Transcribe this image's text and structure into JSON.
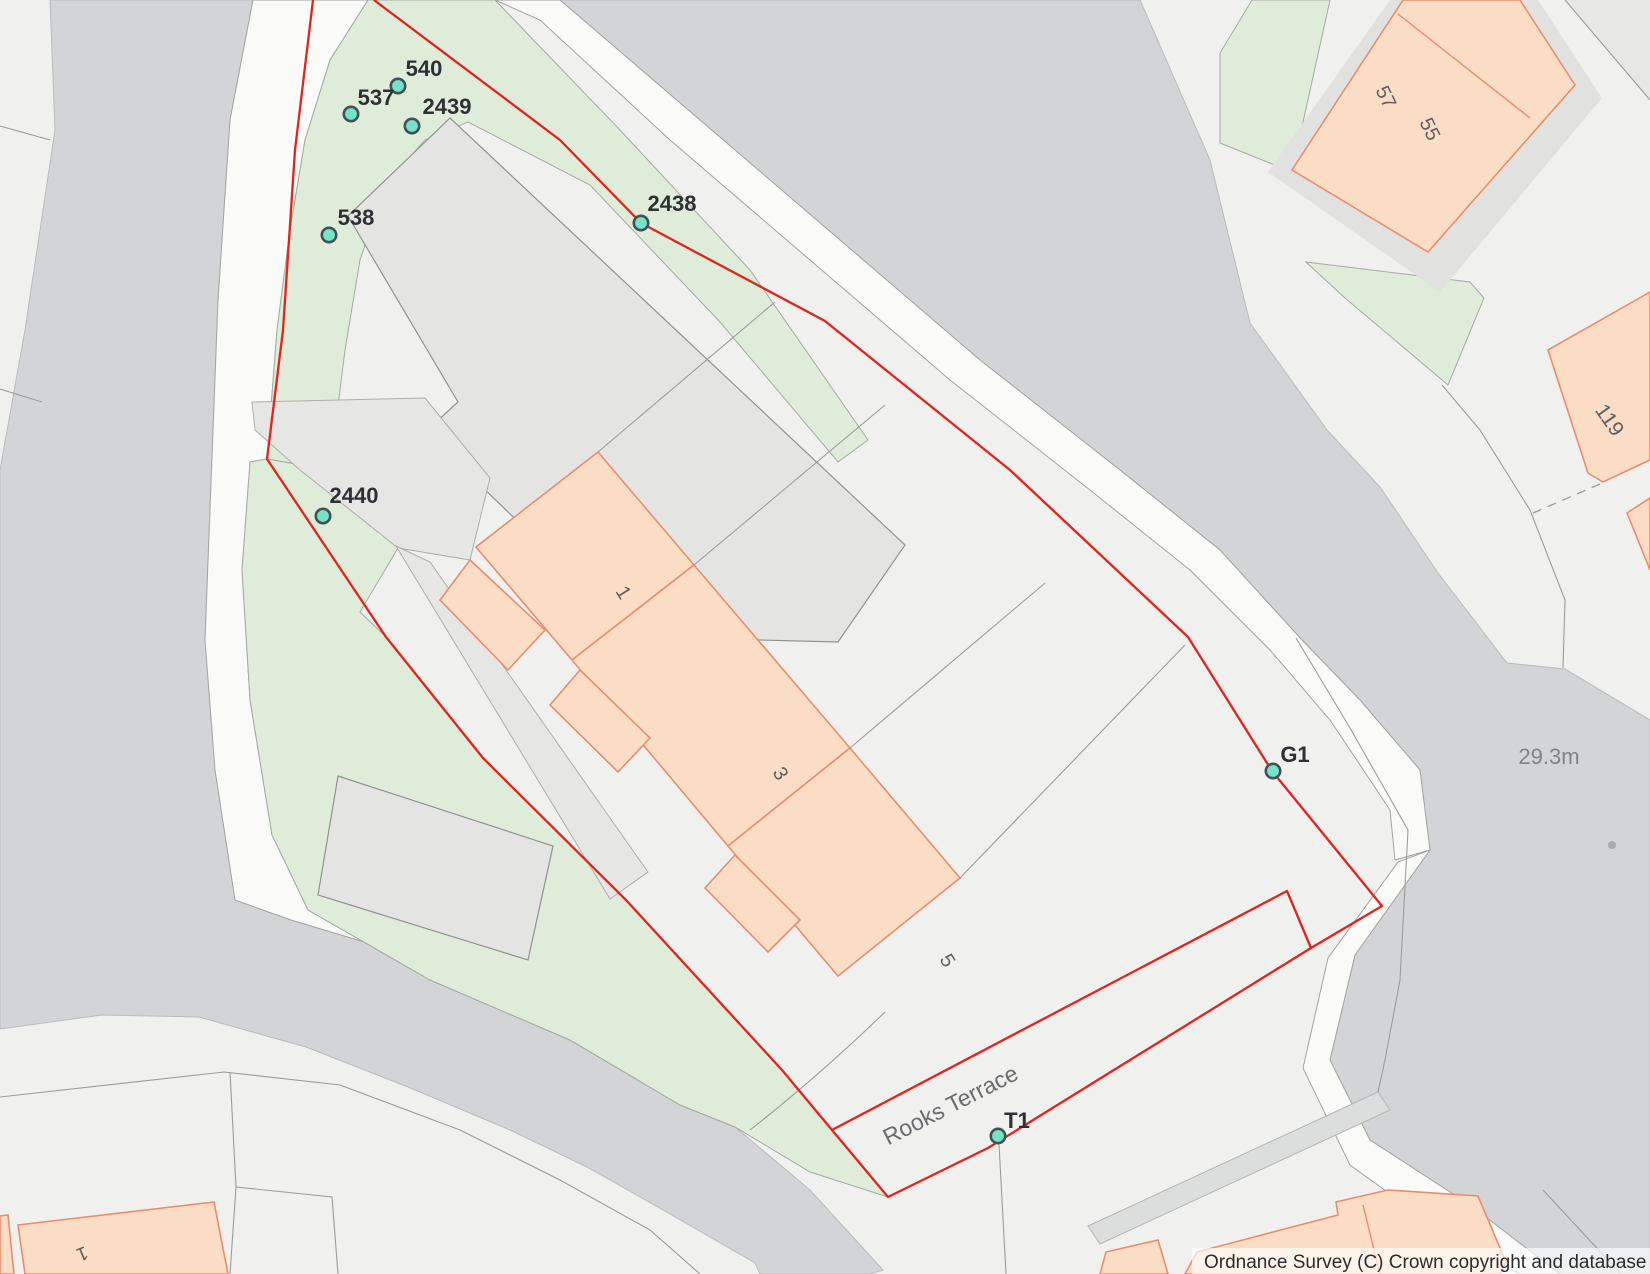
{
  "map": {
    "colors": {
      "background": "#f0f0ef",
      "road": "#d2d4d6",
      "pavement": "#fafaf9",
      "green_area": "#dfecda",
      "grey_building": "#e4e4e3",
      "peach_building": "#fbdcc5",
      "peach_outline": "#ec8c6c",
      "boundary_red": "#e3231d",
      "marker_fill": "#74e3c6",
      "marker_outline": "#415059"
    },
    "markers": [
      {
        "id": "540",
        "label": "540",
        "cx": 398,
        "cy": 86,
        "lx": 424,
        "ly": 76
      },
      {
        "id": "537",
        "label": "537",
        "cx": 351,
        "cy": 114,
        "lx": 376,
        "ly": 105
      },
      {
        "id": "2439",
        "label": "2439",
        "cx": 412,
        "cy": 126,
        "lx": 447,
        "ly": 114
      },
      {
        "id": "538",
        "label": "538",
        "cx": 329,
        "cy": 235,
        "lx": 356,
        "ly": 225
      },
      {
        "id": "2438",
        "label": "2438",
        "cx": 641,
        "cy": 223,
        "lx": 672,
        "ly": 211
      },
      {
        "id": "2440",
        "label": "2440",
        "cx": 323,
        "cy": 516,
        "lx": 354,
        "ly": 503
      },
      {
        "id": "G1",
        "label": "G1",
        "cx": 1273,
        "cy": 771,
        "lx": 1295,
        "ly": 762
      },
      {
        "id": "T1",
        "label": "T1",
        "cx": 998,
        "cy": 1136,
        "lx": 1017,
        "ly": 1128
      }
    ],
    "building_labels": [
      {
        "text": "1",
        "x": 618,
        "y": 596,
        "rot": 58,
        "size": 20
      },
      {
        "text": "3",
        "x": 775,
        "y": 777,
        "rot": 58,
        "size": 20
      },
      {
        "text": "5",
        "x": 942,
        "y": 964,
        "rot": 58,
        "size": 20
      },
      {
        "text": "57",
        "x": 1380,
        "y": 100,
        "rot": 64,
        "size": 20
      },
      {
        "text": "55",
        "x": 1424,
        "y": 132,
        "rot": 64,
        "size": 20
      },
      {
        "text": "119",
        "x": 1604,
        "y": 424,
        "rot": 55,
        "size": 21
      },
      {
        "text": "1",
        "x": 80,
        "y": 1248,
        "rot": 158,
        "size": 19
      }
    ],
    "street": {
      "text": "Rooks Terrace",
      "x": 954,
      "y": 1112,
      "rot": -27
    },
    "elevation": {
      "text": "29.3m",
      "x": 1549,
      "y": 764
    },
    "attribution": {
      "text": "Ordnance Survey (C) Crown copyright and database rights 20"
    }
  }
}
